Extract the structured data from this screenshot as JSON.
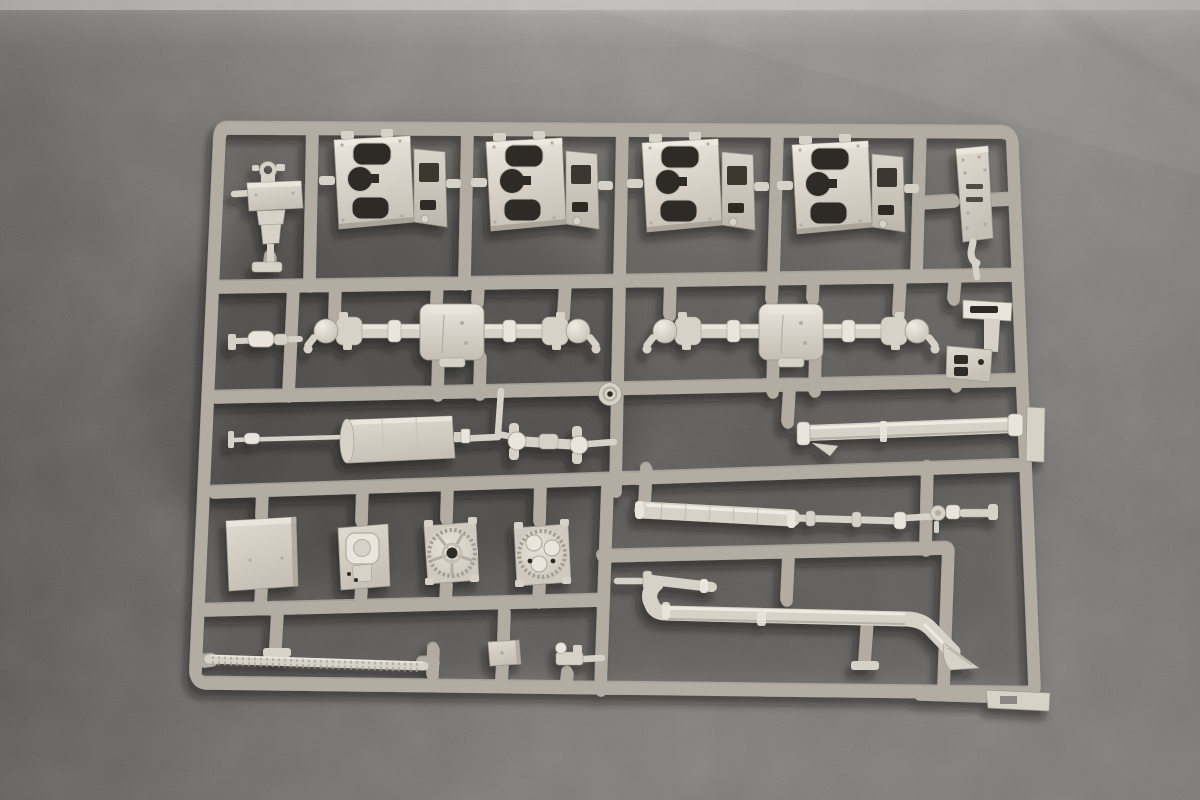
{
  "meta": {
    "kind": "photograph",
    "width_px": 1200,
    "height_px": 800
  },
  "scene": {
    "subject": "Light grey injection-moulded plastic model-kit sprue (parts runner) photographed top-down on dark grey felt fabric",
    "sprue_description": "Rectangular outer runner frame with five internal horizontal runners and short vertical runners forming a grid; chassis parts attached by small gates",
    "lighting": "Soft diffuse light from the upper right; parts cast soft shadows toward lower left",
    "plastic_finish": "matte warm light grey styrene"
  },
  "colors": {
    "plastic-base": "#d7d2c8",
    "plastic-light": "#e9e5dc",
    "plastic-hi": "#f3f0e9",
    "plastic-dark": "#b2aca2",
    "plastic-deep": "#948e84",
    "hole": "#2f2c28",
    "fabric-light": "#c8c6c3",
    "fabric-mid": "#7a7875",
    "fabric-dark": "#5f5c59"
  },
  "parts": [
    {
      "name": "axle-mount-plate",
      "count": 4,
      "desc": "flat housing plate with two oblong openings, one round opening and a boxed side flange",
      "row": "top"
    },
    {
      "name": "shift-tower",
      "count": 1,
      "desc": "small stepped tower with ring head",
      "row": "top-left"
    },
    {
      "name": "instrument-strip",
      "count": 1,
      "desc": "narrow vertical plate with two slots and rivet dots",
      "row": "top-right loop"
    },
    {
      "name": "drive-axle",
      "count": 2,
      "desc": "axle with central differential box, U-joint knuckles and round hub knobs",
      "row": "second"
    },
    {
      "name": "small-cylinder-link",
      "count": 1,
      "desc": "short stepped cylinder link",
      "row": "second-left"
    },
    {
      "name": "z-mount-bracket",
      "count": 1,
      "desc": "Z-shaped bracket with slot and two rectangular holes",
      "row": "second-right"
    },
    {
      "name": "fuel-tank-box",
      "count": 1,
      "desc": "rectangular tank with end cap and nozzle",
      "row": "third"
    },
    {
      "name": "tie-rod",
      "count": 1,
      "desc": "long thin rod with collar",
      "row": "third"
    },
    {
      "name": "u-joint-driveshaft",
      "count": 1,
      "desc": "short shaft with lugged joint flanges at both ends",
      "row": "third"
    },
    {
      "name": "washer-disc",
      "count": 1,
      "desc": "small disc with centre hole moulded on the runner",
      "row": "third"
    },
    {
      "name": "cylinder-tube-long",
      "count": 1,
      "desc": "long smooth tube with end collars and small fin",
      "row": "third-right"
    },
    {
      "name": "stowage-box-flat",
      "count": 1,
      "desc": "plain flat panel box",
      "row": "fourth"
    },
    {
      "name": "winch-box",
      "count": 1,
      "desc": "box with raised rounded-square boss",
      "row": "fourth"
    },
    {
      "name": "geared-drum",
      "count": 2,
      "desc": "square housing with toothed circular drum face",
      "row": "fourth"
    },
    {
      "name": "muffler",
      "count": 1,
      "desc": "ribbed cylinder with end caps",
      "row": "fourth-right"
    },
    {
      "name": "shaft-with-collars",
      "count": 1,
      "desc": "thin shaft with two collars and end knob",
      "row": "fourth-right"
    },
    {
      "name": "pump-assembly-small",
      "count": 1,
      "desc": "small pump body with two wheels",
      "row": "fourth-far-right"
    },
    {
      "name": "exhaust-pipe",
      "count": 1,
      "desc": "long exhaust with front elbow and flattened fishtail tip",
      "row": "bottom-right"
    },
    {
      "name": "tread-strip",
      "count": 1,
      "desc": "long thin strip with fine rib texture",
      "row": "bottom-left"
    },
    {
      "name": "junction-box-small",
      "count": 1,
      "desc": "small rectangular box",
      "row": "bottom"
    },
    {
      "name": "clamp-part-small",
      "count": 1,
      "desc": "tiny clamp with cylinder",
      "row": "bottom"
    },
    {
      "name": "connector-tab",
      "count": 2,
      "desc": "flat inter-sprue connector tab on frame edge",
      "row": "right / bottom-right"
    }
  ]
}
